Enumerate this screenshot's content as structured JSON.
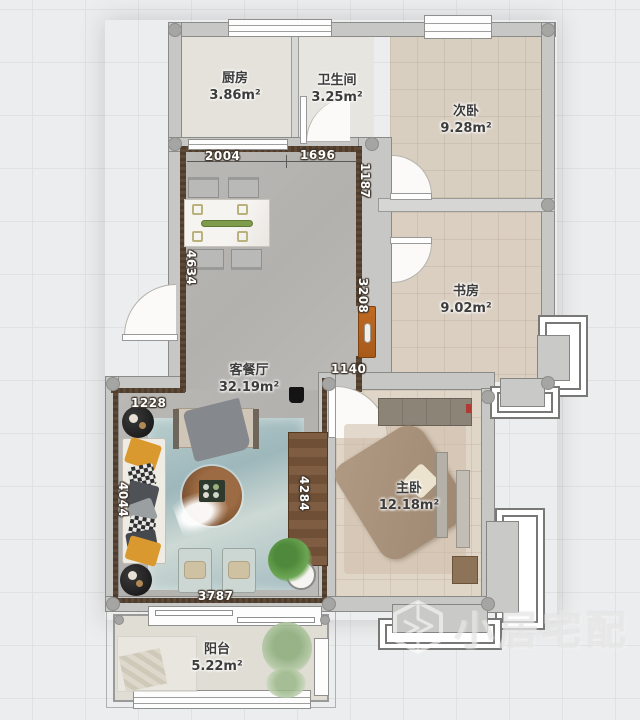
{
  "app": {
    "watermark_brand": "小居宅配"
  },
  "rooms": [
    {
      "id": "kitchen",
      "name": "厨房",
      "area": "3.86m²"
    },
    {
      "id": "bathroom",
      "name": "卫生间",
      "area": "3.25m²"
    },
    {
      "id": "bedroom2",
      "name": "次卧",
      "area": "9.28m²"
    },
    {
      "id": "study",
      "name": "书房",
      "area": "9.02m²"
    },
    {
      "id": "living",
      "name": "客餐厅",
      "area": "32.19m²"
    },
    {
      "id": "master",
      "name": "主卧",
      "area": "12.18m²"
    },
    {
      "id": "balcony",
      "name": "阳台",
      "area": "5.22m²"
    }
  ],
  "dimensions_mm": {
    "living_top_left": "2004",
    "living_top_right": "1696",
    "living_right_upper": "1187",
    "living_left": "4634",
    "living_right_lower": "3208",
    "entry_width": "1140",
    "sofa_bay_top": "1228",
    "sofa_wall": "4044",
    "living_bottom": "3787",
    "console_wall": "4284"
  },
  "colors": {
    "living_floor": "#b7b5b1",
    "bedroom_floor": "#d9cfc1",
    "master_floor": "#e0d6c8",
    "wall_fill": "#c7c7c5",
    "accent_wood": "#5d4936",
    "entry_door": "#b8651f",
    "sofa_cushion_orange": "#d9992f",
    "rug_teal": "#a9c1c4"
  }
}
